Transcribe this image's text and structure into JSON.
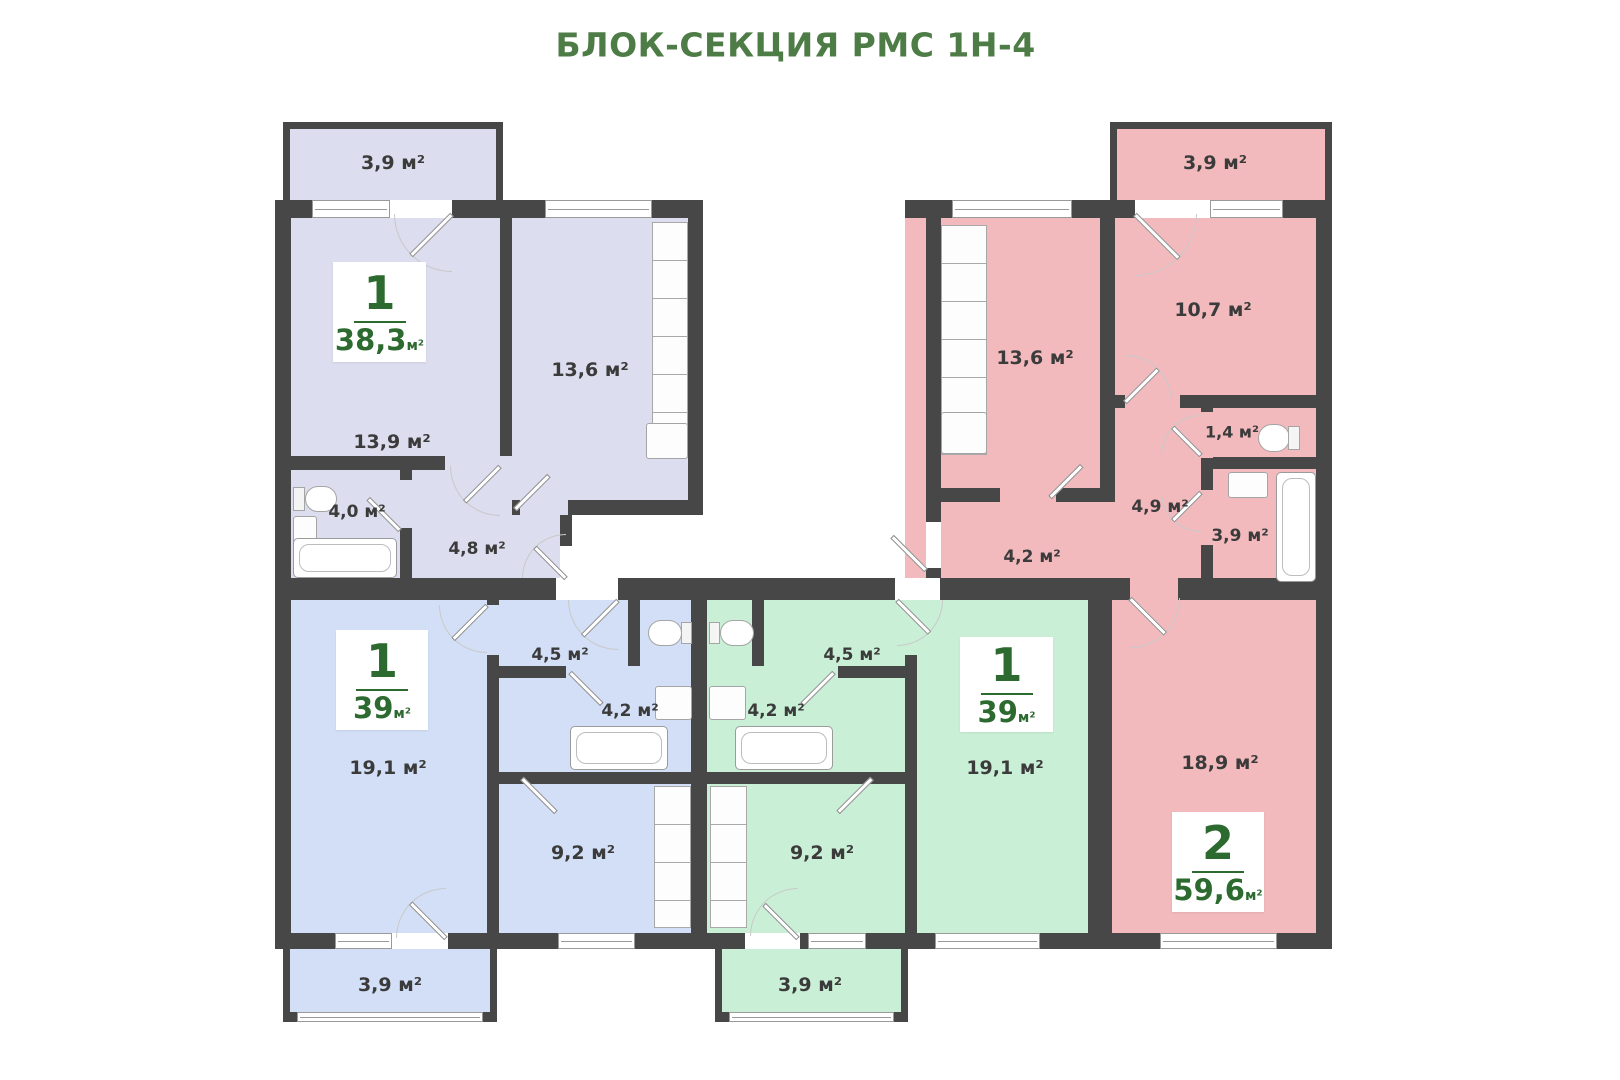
{
  "title": "БЛОК-СЕКЦИЯ РМС 1Н-4",
  "colors": {
    "title_green": "#4e7c46",
    "badge_green": "#2d6a2f",
    "label_text": "#3b3b3b",
    "wall": "#474747",
    "lavender": "#dcddee",
    "pink": "#f2babd",
    "blue": "#d2dff6",
    "green": "#c9f0d6"
  },
  "apartments": {
    "top_left": {
      "badge": {
        "rooms": "1",
        "area": "38,3",
        "unit": "м²"
      },
      "rooms": {
        "balcony": "3,9 м²",
        "room": "13,9 м²",
        "kitchen": "13,6 м²",
        "bathroom": "4,0 м²",
        "hallway": "4,8 м²"
      }
    },
    "top_right": {
      "badge": {
        "rooms": "2",
        "area": "59,6",
        "unit": "м²"
      },
      "rooms": {
        "balcony": "3,9 м²",
        "kitchen": "13,6 м²",
        "bedroom": "10,7 м²",
        "wc": "1,4 м²",
        "hallway": "4,9 м²",
        "bathroom": "3,9 м²",
        "corridor": "4,2 м²",
        "living": "18,9 м²"
      }
    },
    "bottom_left": {
      "badge": {
        "rooms": "1",
        "area": "39",
        "unit": "м²"
      },
      "rooms": {
        "living": "19,1 м²",
        "hallway": "4,5 м²",
        "bathroom": "4,2 м²",
        "kitchen": "9,2 м²",
        "balcony": "3,9 м²"
      }
    },
    "bottom_middle": {
      "badge": {
        "rooms": "1",
        "area": "39",
        "unit": "м²"
      },
      "rooms": {
        "hallway": "4,5 м²",
        "bathroom": "4,2 м²",
        "kitchen": "9,2 м²",
        "living": "19,1 м²",
        "balcony": "3,9 м²"
      }
    }
  }
}
